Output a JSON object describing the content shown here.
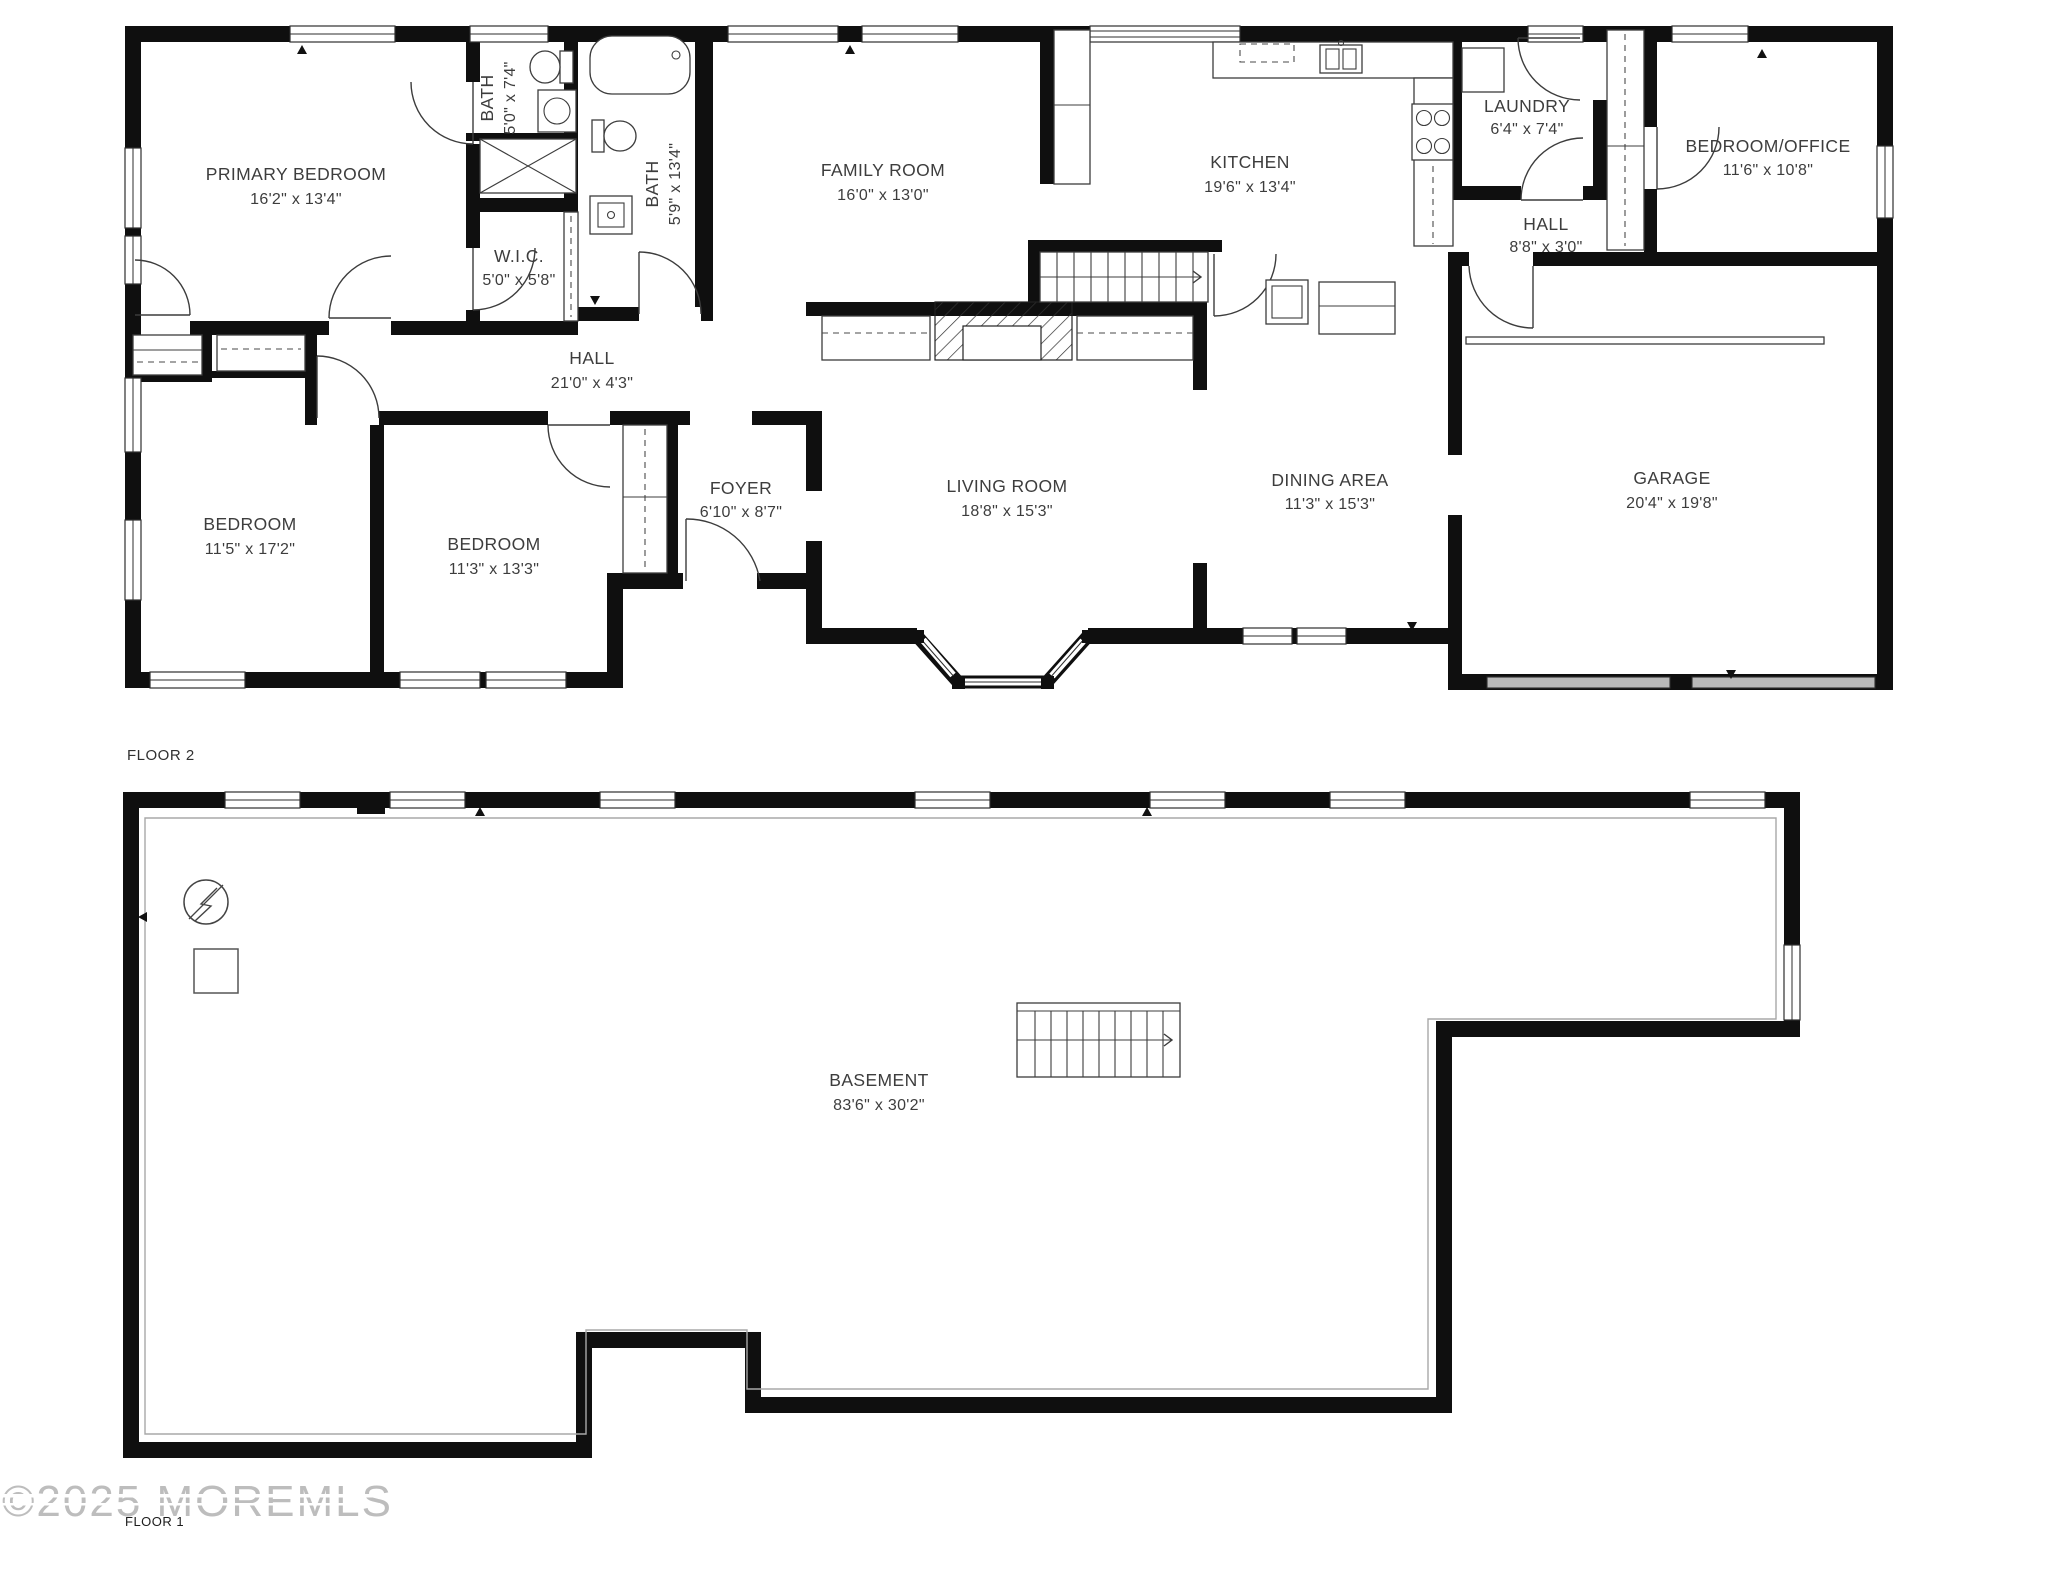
{
  "rooms": [
    {
      "id": "primary-bedroom",
      "name": "PRIMARY BEDROOM",
      "dims": "16'2\" x 13'4\""
    },
    {
      "id": "bath-1",
      "name": "BATH",
      "dims": "5'0\" x 7'4\""
    },
    {
      "id": "wic",
      "name": "W.I.C.",
      "dims": "5'0\" x 5'8\""
    },
    {
      "id": "bath-2",
      "name": "BATH",
      "dims": "5'9\" x 13'4\""
    },
    {
      "id": "family-room",
      "name": "FAMILY ROOM",
      "dims": "16'0\" x 13'0\""
    },
    {
      "id": "kitchen",
      "name": "KITCHEN",
      "dims": "19'6\" x 13'4\""
    },
    {
      "id": "laundry",
      "name": "LAUNDRY",
      "dims": "6'4\" x 7'4\""
    },
    {
      "id": "hall-small",
      "name": "HALL",
      "dims": "8'8\" x 3'0\""
    },
    {
      "id": "bedroom-office",
      "name": "BEDROOM/OFFICE",
      "dims": "11'6\" x 10'8\""
    },
    {
      "id": "hall-long",
      "name": "HALL",
      "dims": "21'0\" x 4'3\""
    },
    {
      "id": "bedroom-1",
      "name": "BEDROOM",
      "dims": "11'5\" x 17'2\""
    },
    {
      "id": "bedroom-2",
      "name": "BEDROOM",
      "dims": "11'3\" x 13'3\""
    },
    {
      "id": "foyer",
      "name": "FOYER",
      "dims": "6'10\" x 8'7\""
    },
    {
      "id": "living-room",
      "name": "LIVING ROOM",
      "dims": "18'8\" x 15'3\""
    },
    {
      "id": "dining-area",
      "name": "DINING AREA",
      "dims": "11'3\" x 15'3\""
    },
    {
      "id": "garage",
      "name": "GARAGE",
      "dims": "20'4\" x 19'8\""
    },
    {
      "id": "basement",
      "name": "BASEMENT",
      "dims": "83'6\" x 30'2\""
    }
  ],
  "labels": {
    "floor1": "FLOOR 1",
    "floor2": "FLOOR 2"
  },
  "watermark": {
    "text": "©2025 MOREMLS"
  },
  "colors": {
    "wall": "#0f0f0f",
    "label_text": "#3d3d3d",
    "watermark": "#bdbdbd",
    "garage_door": "#b9b9b9"
  }
}
